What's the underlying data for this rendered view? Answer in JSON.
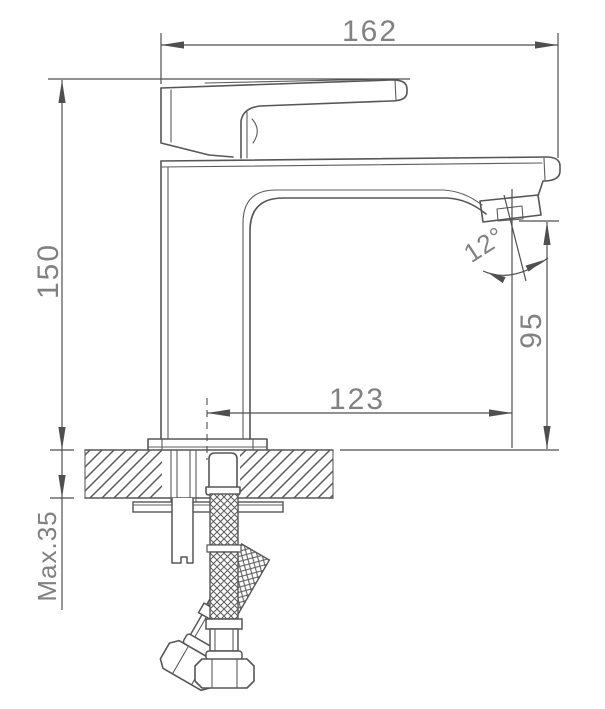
{
  "drawing": {
    "subject": "single-lever basin faucet",
    "view": "side elevation installation drawing",
    "style": "monochrome technical line drawing",
    "units": "mm",
    "colors": {
      "line": "#565656",
      "dimension_line": "#4f4f4f",
      "text": "#818181",
      "background": "#ffffff"
    },
    "dimensions": {
      "overall_width": "162",
      "overall_height": "150",
      "spout_reach": "123",
      "outlet_height": "95",
      "outlet_angle": "12°",
      "max_mounting_thickness": "Max.35"
    },
    "parts": [
      "lever-handle",
      "spout-body",
      "aerator-outlet",
      "base-flange",
      "mounting-deck-hatched",
      "backing-plate",
      "threaded-fixing-stud",
      "flexible-supply-hose-straight",
      "flexible-supply-hose-angled"
    ]
  }
}
